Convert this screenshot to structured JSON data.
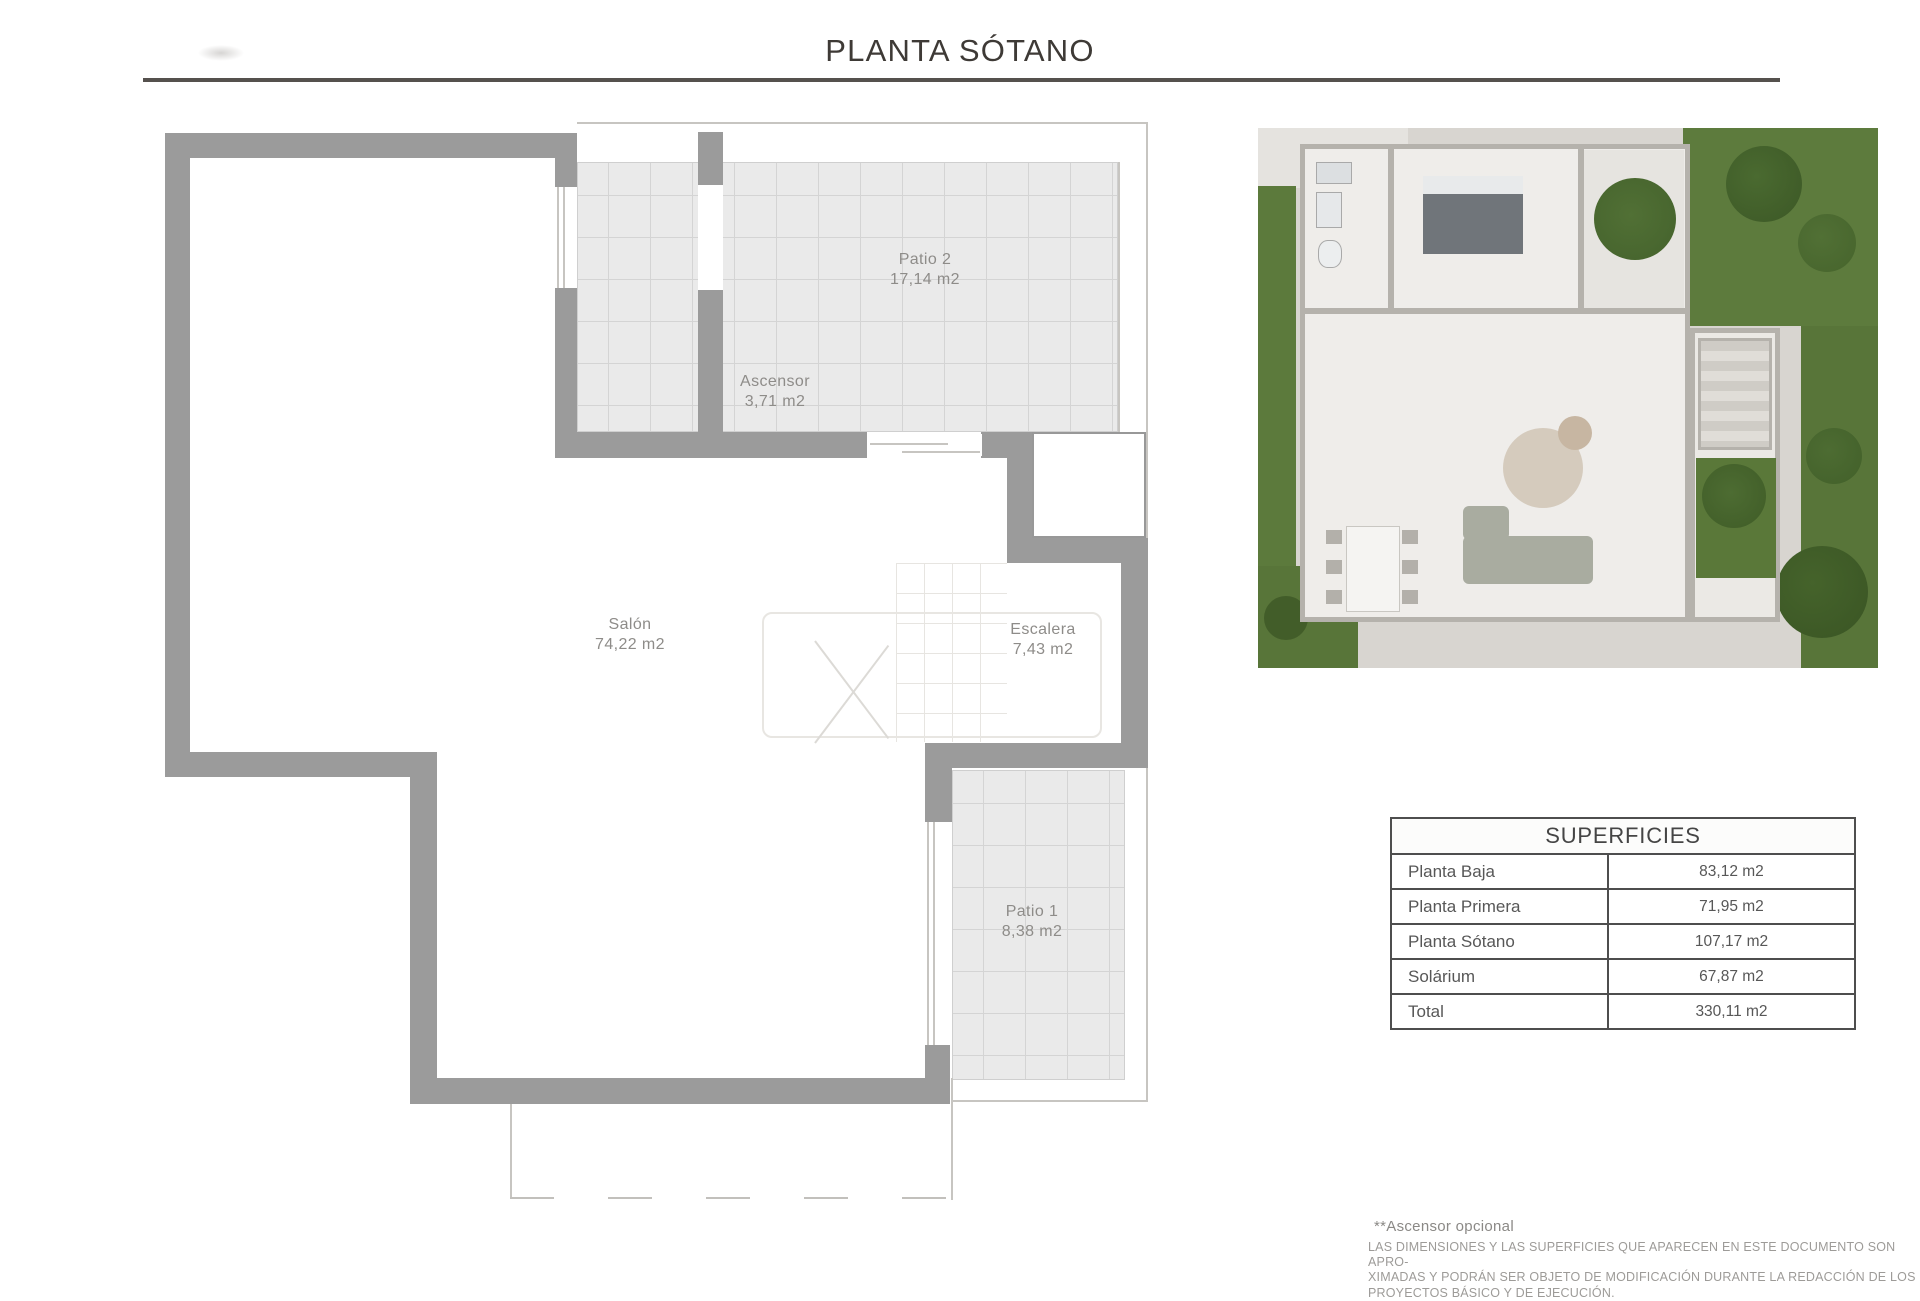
{
  "page": {
    "title": "PLANTA SÓTANO"
  },
  "plan": {
    "rooms": [
      {
        "name": "Patio 2",
        "area": "17,14 m2"
      },
      {
        "name": "Ascensor",
        "area": "3,71 m2"
      },
      {
        "name": "Salón",
        "area": "74,22 m2"
      },
      {
        "name": "Escalera",
        "area": "7,43 m2"
      },
      {
        "name": "Patio 1",
        "area": "8,38 m2"
      }
    ]
  },
  "table": {
    "header": "SUPERFICIES",
    "rows": [
      {
        "label": "Planta Baja",
        "value": "83,12 m2"
      },
      {
        "label": "Planta Primera",
        "value": "71,95 m2"
      },
      {
        "label": "Planta Sótano",
        "value": "107,17 m2"
      },
      {
        "label": "Solárium",
        "value": "67,87 m2"
      },
      {
        "label": "Total",
        "value": "330,11 m2"
      }
    ]
  },
  "footer": {
    "note": "**Ascensor opcional",
    "disclaimer_lines": [
      "LAS DIMENSIONES Y LAS SUPERFICIES QUE APARECEN EN ESTE DOCUMENTO SON APRO-",
      "XIMADAS Y PODRÁN SER OBJETO DE MODIFICACIÓN DURANTE LA REDACCIÓN DE LOS",
      "PROYECTOS BÁSICO Y DE EJECUCIÓN."
    ]
  },
  "colors": {
    "wall": "#9b9b9b",
    "tile_fill": "#eaeaea",
    "tile_line": "#d4d4d4",
    "rule": "#55514d",
    "label_text": "#8e8c89",
    "table_border": "#4e4e4e",
    "lawn_green": "#5c7a3c"
  }
}
